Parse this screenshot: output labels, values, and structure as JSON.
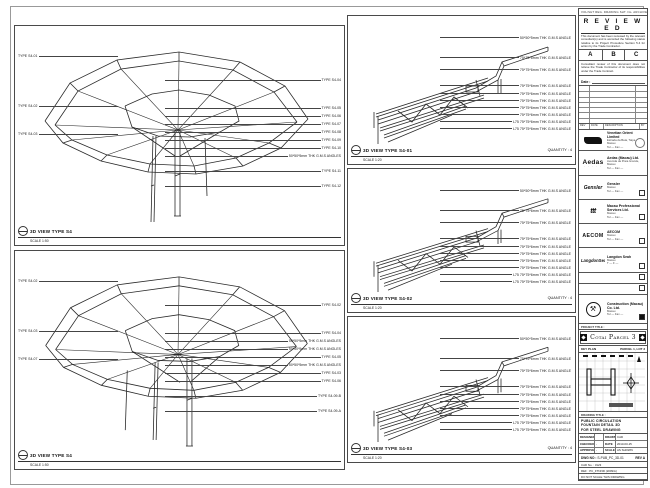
{
  "views": {
    "top_left": {
      "title": "3D VIEW TYPE S4",
      "scale": "SCALE 1:50",
      "left_labels": [
        "TYPE S4-01",
        "TYPE S4-02",
        "TYPE S4-03"
      ],
      "right_labels": [
        "TYPE S4-04",
        "TYPE S4-05",
        "TYPE S4-06",
        "TYPE S4-07",
        "TYPE S4-08",
        "TYPE S4-09",
        "TYPE S4-10",
        "50*50*5mm THK G.M.S ANGLES",
        "TYPE S4-11",
        "TYPE S4-12"
      ]
    },
    "bottom_left": {
      "title": "3D VIEW TYPE S4",
      "scale": "SCALE 1:50",
      "left_labels": [
        "TYPE S4-02",
        "TYPE S4-03",
        "TYPE S4-07"
      ],
      "right_labels": [
        "TYPE S4-02",
        "TYPE S4-04",
        "50*50*5mm THK G.M.S ANGLES",
        "50*50*5mm THK G.M.S ANGLES",
        "TYPE S4-05",
        "50*50*5mm THK G.M.S ANGLES",
        "TYPE S4-03",
        "TYPE S4-06",
        "TYPE S4-09-B",
        "TYPE S4-09-A"
      ]
    },
    "details": [
      {
        "title": "3D VIEW TYPE S4-01",
        "scale": "SCALE 1:20",
        "quantity": "QUANTITY : 4",
        "labels": [
          "50*50*5mm THK G.M.S ANGLE",
          "75*75*6mm THK G.M.S ANGLE",
          "75*75*6mm THK G.M.S ANGLE",
          "75*75*6mm THK G.M.S ANGLE",
          "75*75*6mm THK G.M.S ANGLE",
          "75*75*6mm THK G.M.S ANGLE",
          "75*75*6mm THK G.M.S ANGLE",
          "75*75*6mm THK G.M.S ANGLE",
          "L75 75*75*6mm THK G.M.S ANGLE",
          "L75 75*75*6mm THK G.M.S ANGLE"
        ]
      },
      {
        "title": "3D VIEW TYPE S4-02",
        "scale": "SCALE 1:20",
        "quantity": "QUANTITY : 4",
        "labels": [
          "50*50*5mm THK G.M.S ANGLE",
          "75*75*6mm THK G.M.S ANGLE",
          "75*75*6mm THK G.M.S ANGLE",
          "75*75*6mm THK G.M.S ANGLE",
          "75*75*6mm THK G.M.S ANGLE",
          "75*75*6mm THK G.M.S ANGLE",
          "75*75*6mm THK G.M.S ANGLE",
          "75*75*6mm THK G.M.S ANGLE",
          "L75 75*75*6mm THK G.M.S ANGLE",
          "L75 75*75*6mm THK G.M.S ANGLE"
        ]
      },
      {
        "title": "3D VIEW TYPE S4-03",
        "scale": "SCALE 1:20",
        "quantity": "QUANTITY : 4",
        "labels": [
          "50*50*5mm THK G.M.S ANGLE",
          "75*75*6mm THK G.M.S ANGLE",
          "75*75*6mm THK G.M.S ANGLE",
          "75*75*6mm THK G.M.S ANGLE",
          "75*75*6mm THK G.M.S ANGLE",
          "75*75*6mm THK G.M.S ANGLE",
          "75*75*6mm THK G.M.S ANGLE",
          "75*75*6mm THK G.M.S ANGLE",
          "L75 75*75*6mm THK G.M.S ANGLE",
          "L75 75*75*6mm THK G.M.S ANGLE"
        ]
      }
    ]
  },
  "stamp": {
    "header": "VOL/SHT REG. DRAWING SHT. No. ARCHIVE No. CS",
    "title": "R E V I E W E D",
    "body1": "This document has been reviewed by the relevant consultant(s) and is accorded the following status relative to its Project Procedure Section 5.4 for action by the Trade Contractor.",
    "grades": {
      "a": "A",
      "b": "B",
      "c": "C"
    },
    "body2": "Consultant review of this document does not relieve the Trade Contractor of its responsibilities under the Trade Contract.",
    "date_label": "Date :",
    "footer": {
      "c1": "REV",
      "c2": "DATE",
      "c3": "DESCRIPTION",
      "c4": "BY"
    }
  },
  "consultants": [
    {
      "name": "Venetian Orient Limited",
      "l1": "Estrada da Baía, Taipa, Macau",
      "l2": "Tel — Fax —"
    },
    {
      "logo_text": "Aedas",
      "dots": "· · · · ·",
      "name": "Aedas (Macau) Ltd.",
      "l1": "Avenida da Praia Grande, Macau",
      "l2": "Tel — Fax —"
    },
    {
      "logo_text": "Gensler",
      "name": "Gensler",
      "l1": "Macau",
      "l2": "Tel — Fax —"
    },
    {
      "logo_text": "ttt",
      "name": "Macau Professional Services Ltd.",
      "l1": "Macau",
      "l2": "Tel — Fax —"
    },
    {
      "logo_text": "AECOM",
      "name": "AECOM",
      "l1": "Macau",
      "l2": "Tel — Fax —"
    },
    {
      "logo_text": "LangdonSeah",
      "name": "Langdon Seah",
      "l1": "Macau",
      "l2": "T — F —"
    },
    {
      "logo_glyph": "⚒",
      "name": "Construction (Macau) Co. Ltd.",
      "l1": "Macau",
      "l2": "Tel — Fax —"
    }
  ],
  "project": {
    "project_title_label": "PROJECT TITLE :",
    "title": "Cotai Parcel 3",
    "key_plan_label": "KEY PLAN",
    "parcel_label": "PARCEL 1, LOT 3"
  },
  "drawing_info": {
    "title_label": "DRAWING TITLE :",
    "line1": "PUBLIC CIRCULATION",
    "line2": "FOUNTAIN DETAIL 3D",
    "line3": "FOR STEEL DRAWING",
    "fields": {
      "designed_label": "DESIGNED",
      "designed": "",
      "drawn_label": "DRAWN",
      "drawn": "CAD",
      "checked_label": "CHECKED",
      "checked": "-",
      "date_label": "DATE",
      "date": "2013-03-15",
      "approved_label": "APPROVED",
      "approved": "-",
      "scale_label": "SCALE",
      "scale": "AS SHOWN"
    },
    "dwg_label": "DWG NO :",
    "dwg_no": "S-PUB_PC_3D-01",
    "rev": "REV  A",
    "cad_row": "CAD No. :  3123",
    "note_row": "REF : PC_FTN/3D (2009/A)",
    "status_row": "DO NOT SCALE THIS DRAWING"
  }
}
